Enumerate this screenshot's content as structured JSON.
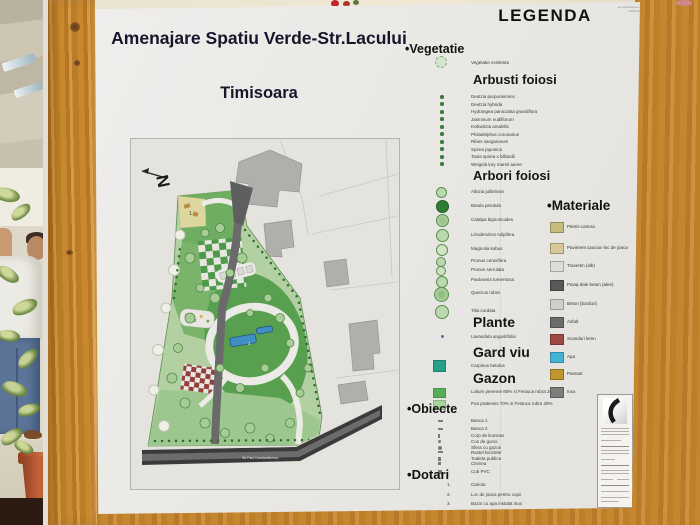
{
  "poster": {
    "title": "Amenajare Spatiu Verde-Str.Lacului",
    "subtitle": "Timisoara",
    "watermark_line1": "an educational version",
    "watermark_line2": "GRAPHISOFT"
  },
  "map": {
    "north_label": "N",
    "street_label": "Str Paul Constantinescu",
    "marker1": "1",
    "marker2": "2",
    "marker3": "3"
  },
  "legend": {
    "title": "LEGENDA",
    "bullet": "•",
    "vegetatie_label": "Vegetatie",
    "vegetatie_existenta": "Vegetatie existenta",
    "arbusti_heading": "Arbusti foiosi",
    "arbusti_items": [
      "Deutzia purpurascens",
      "Deutzia hybrida",
      "Hydrangea paniculata grandiflora",
      "Jasminum nudiflorum",
      "Kolkwitzia amabilis",
      "Philadelphus coronarius",
      "Ribes sanguineum",
      "Spirea japonica",
      "Taula spirea x billiardii",
      "Weigela lory mareil auree"
    ],
    "arbori_heading": "Arbori foiosi",
    "arbori_items": [
      "Albizia julibrissin",
      "Betula pendula",
      "Catalpa bignonioides",
      "Liriodendron tulipifera",
      "Magnolia kobus",
      "Prunus cerasifera",
      "Prunus serrulata",
      "Paulownia tomentosa",
      "Quercus rubra",
      "Tilia cordata"
    ],
    "plante_heading": "Plante",
    "plante_items": [
      "Lavandula angustifolia"
    ],
    "gardviu_heading": "Gard viu",
    "gardviu_items": [
      {
        "label": "Carpinus betulus",
        "swatch": "background:#27a088"
      }
    ],
    "gazon_heading": "Gazon",
    "gazon_items": [
      {
        "label": "Lolium perenne 80% si Festuca rubra 20%",
        "swatch": "background:#58ae58"
      },
      {
        "label": "Poa pratensis 70% si Festuca rubra 30%",
        "swatch": "background:#a6d39b"
      }
    ],
    "obiecte_label": "Obiecte",
    "obiecte_items": [
      "Banca 1",
      "Banca 2",
      "Corp de iluminat",
      "Cos de gunoi",
      "Sfera cu gazon",
      "Rastel biciclete",
      "Toaleta publica",
      "Cismea",
      "Cub PVC"
    ],
    "dotari_label": "Dotari",
    "dotari_items": [
      {
        "num": "1.",
        "label": "Cariota"
      },
      {
        "num": "2.",
        "label": "Loc de joaca pentru copii"
      },
      {
        "num": "3.",
        "label": "Bazin cu apa instalat inox"
      }
    ],
    "materiale_label": "Materiale",
    "materiale_items": [
      {
        "label": "Pietris-cariera",
        "swatch": "background:#c5bd7d"
      },
      {
        "label": "Paviment cauciuc-loc de joaca",
        "swatch": "background:#d9c79c"
      },
      {
        "label": "Travertin (alb)",
        "swatch": "background:#dedcd7"
      },
      {
        "label": "Pavaj-dale beton (alee)",
        "swatch": "background:#585858"
      },
      {
        "label": "Beton (borduri)",
        "swatch": "background:#cfcecb"
      },
      {
        "label": "Asfalt",
        "swatch": "background:#6b6b6b"
      },
      {
        "label": "Scanduri lemn",
        "swatch": "background:#9c4a44"
      },
      {
        "label": "Apa",
        "swatch": "background:#45b4d4"
      },
      {
        "label": "Pamant",
        "swatch": "background:#c1952d"
      },
      {
        "label": "Inox",
        "swatch": "background:#7d7d7d"
      }
    ]
  },
  "colors": {
    "park_green": "#58a04f",
    "water_blue": "#3f8fc4",
    "wood_board": "#c4862f",
    "checker_red": "#93403c"
  }
}
